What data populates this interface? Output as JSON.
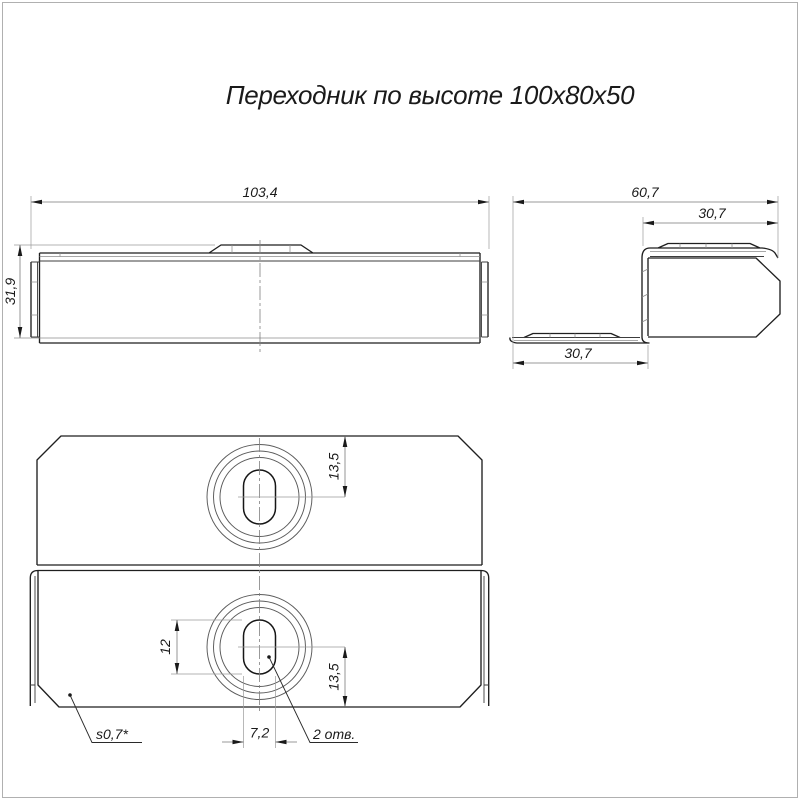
{
  "title": "Переходник по высоте 100х80х50",
  "views": {
    "side": {
      "dim_width": "103,4",
      "dim_height": "31,9"
    },
    "profile": {
      "dim_overall": "60,7",
      "dim_top_flange": "30,7",
      "dim_bottom_flange": "30,7"
    },
    "plan": {
      "dim_hole_offset_top": "13,5",
      "dim_slot_length": "12",
      "dim_hole_offset_bottom": "13,5",
      "dim_slot_width": "7,2",
      "note_holes": "2 отв.",
      "note_thickness": "s0,7*"
    }
  },
  "colors": {
    "background": "#ffffff",
    "line": "#1f1f1f",
    "thin_line": "#8c8c8c",
    "text": "#1a1a1a"
  }
}
